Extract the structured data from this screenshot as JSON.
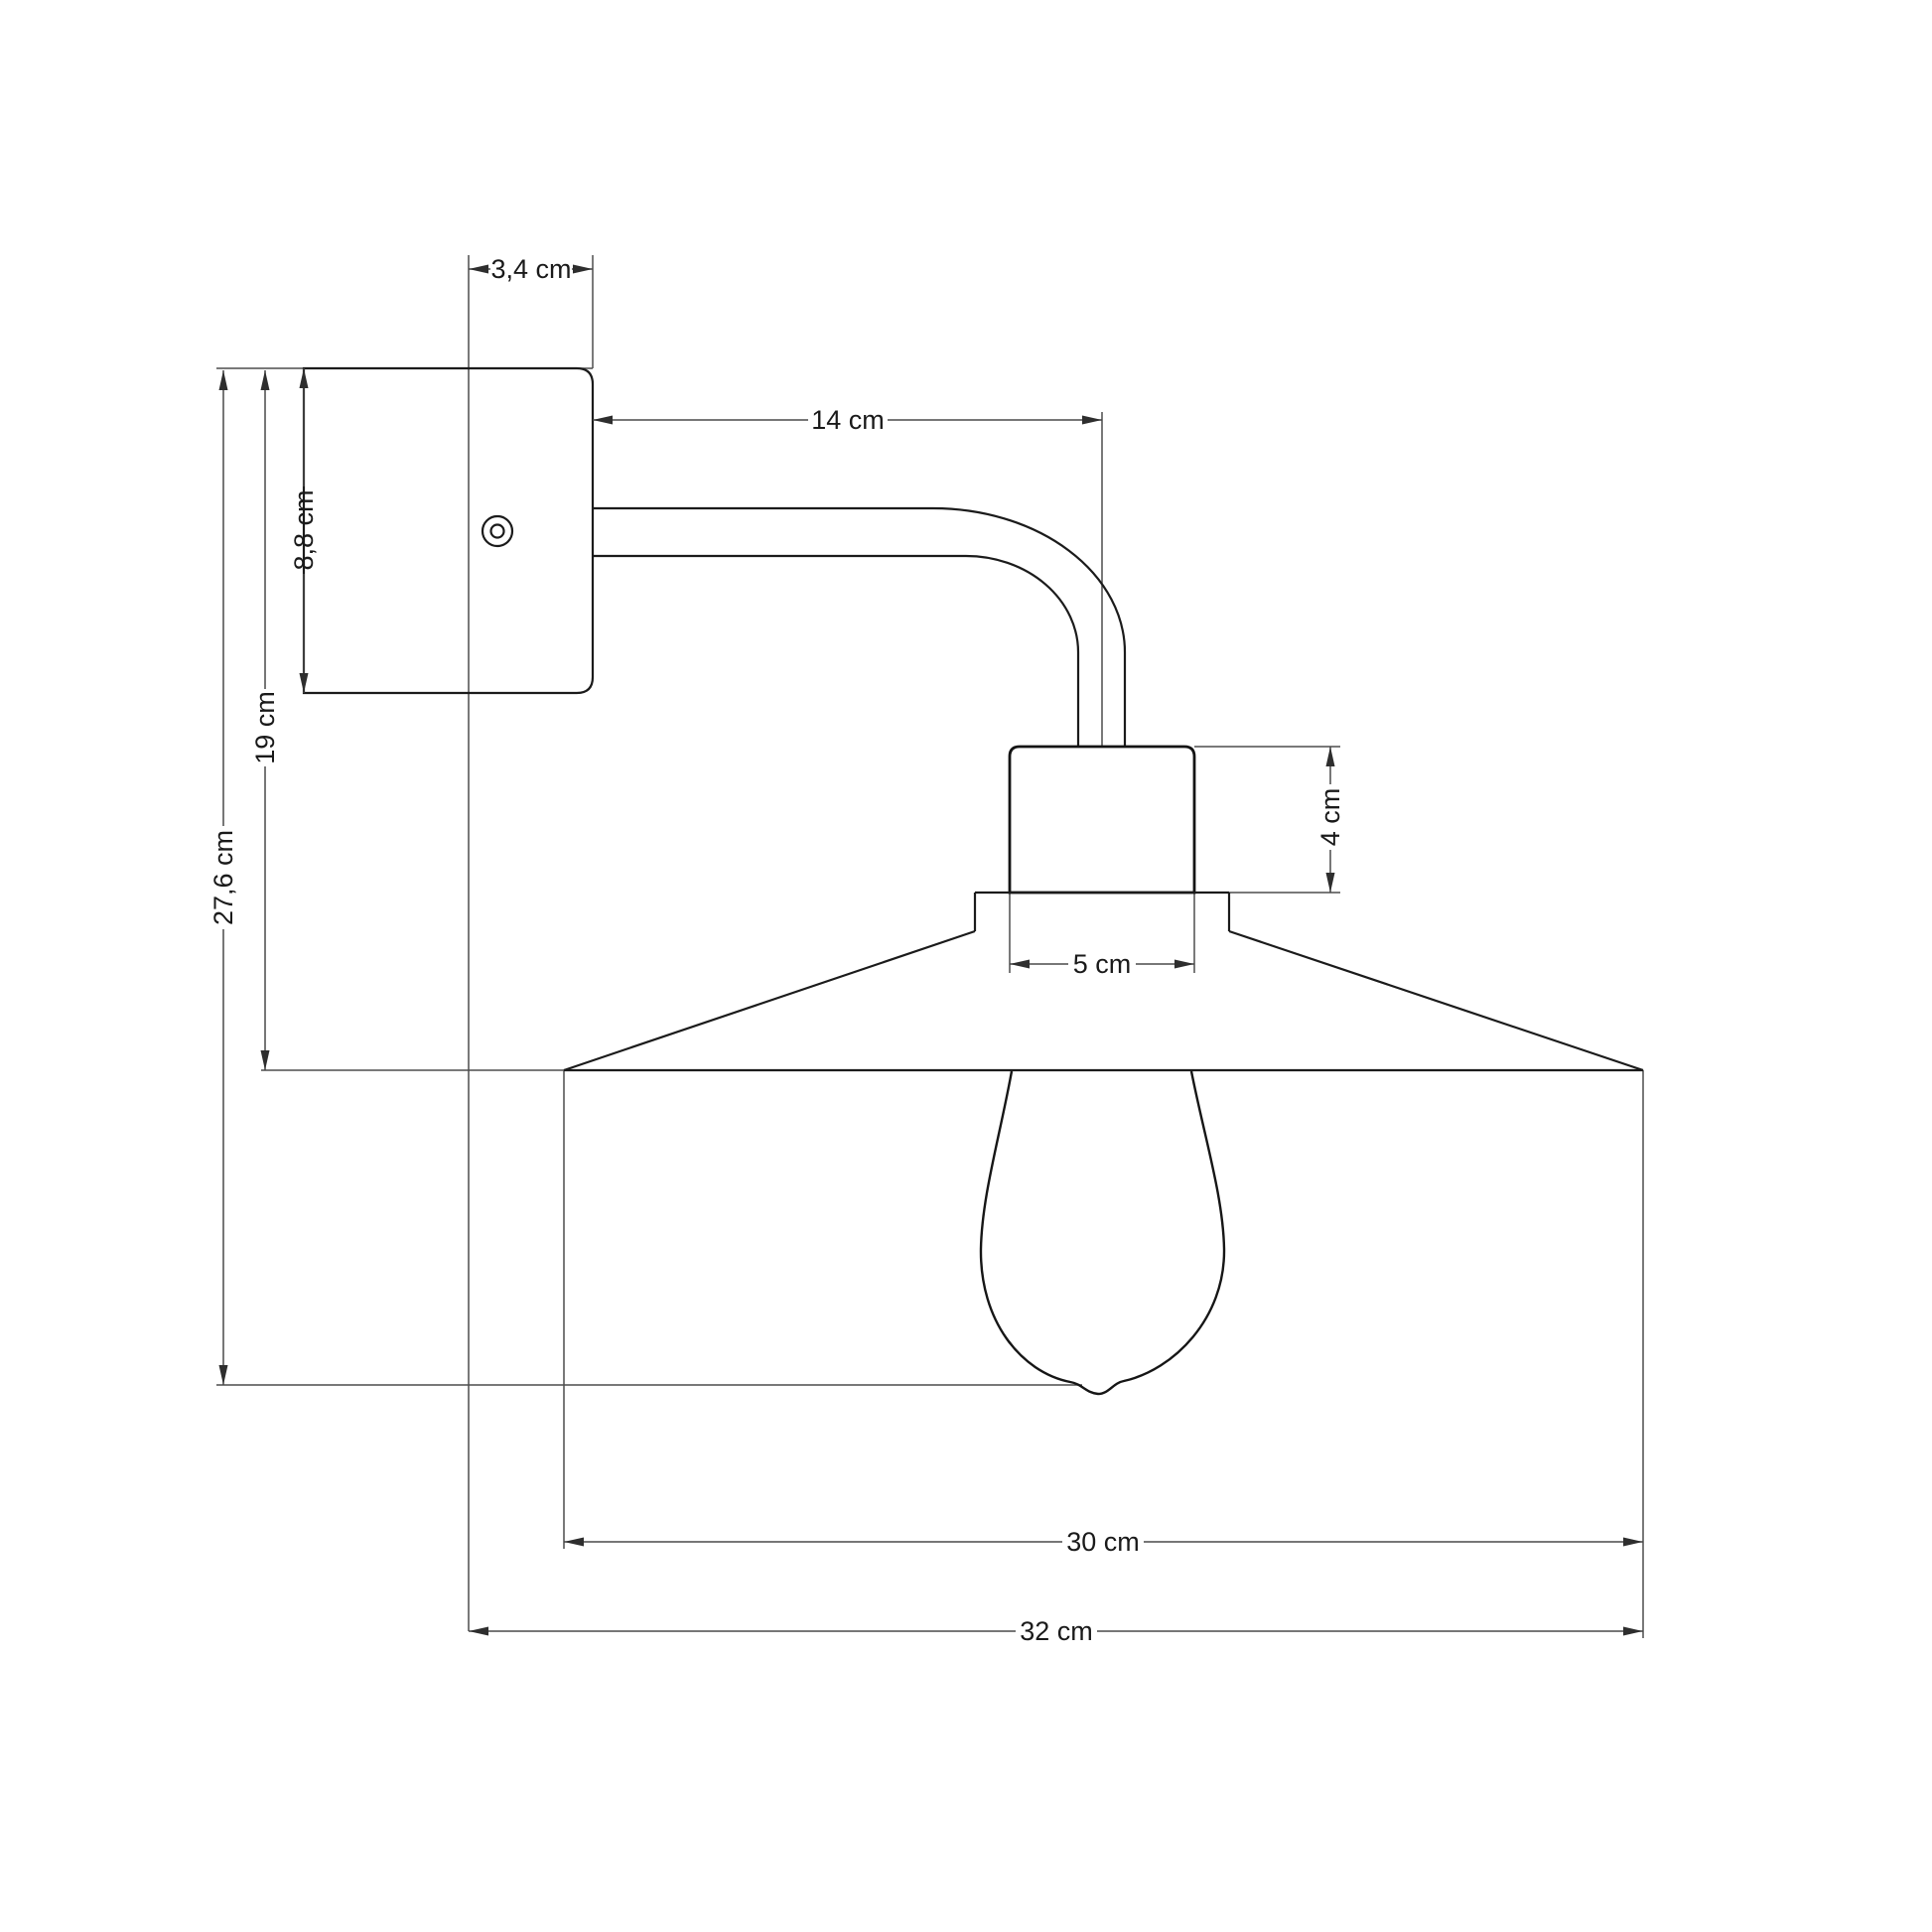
{
  "diagram": {
    "type": "technical-dimension-drawing",
    "subject": "wall lamp with conical shade and filament bulb, side elevation",
    "background_color": "#ffffff",
    "object_line_color": "#1b1b1b",
    "dimension_line_color": "#4a4a4a",
    "units": "cm",
    "dimensions": {
      "plate_projection": "3,4 cm",
      "arm_reach": "14 cm",
      "plate_height": "8,8 cm",
      "top_to_shade_rim": "19 cm",
      "total_height": "27,6 cm",
      "socket_height": "4 cm",
      "socket_width": "5 cm",
      "shade_diameter": "30 cm",
      "total_projection": "32 cm"
    }
  }
}
